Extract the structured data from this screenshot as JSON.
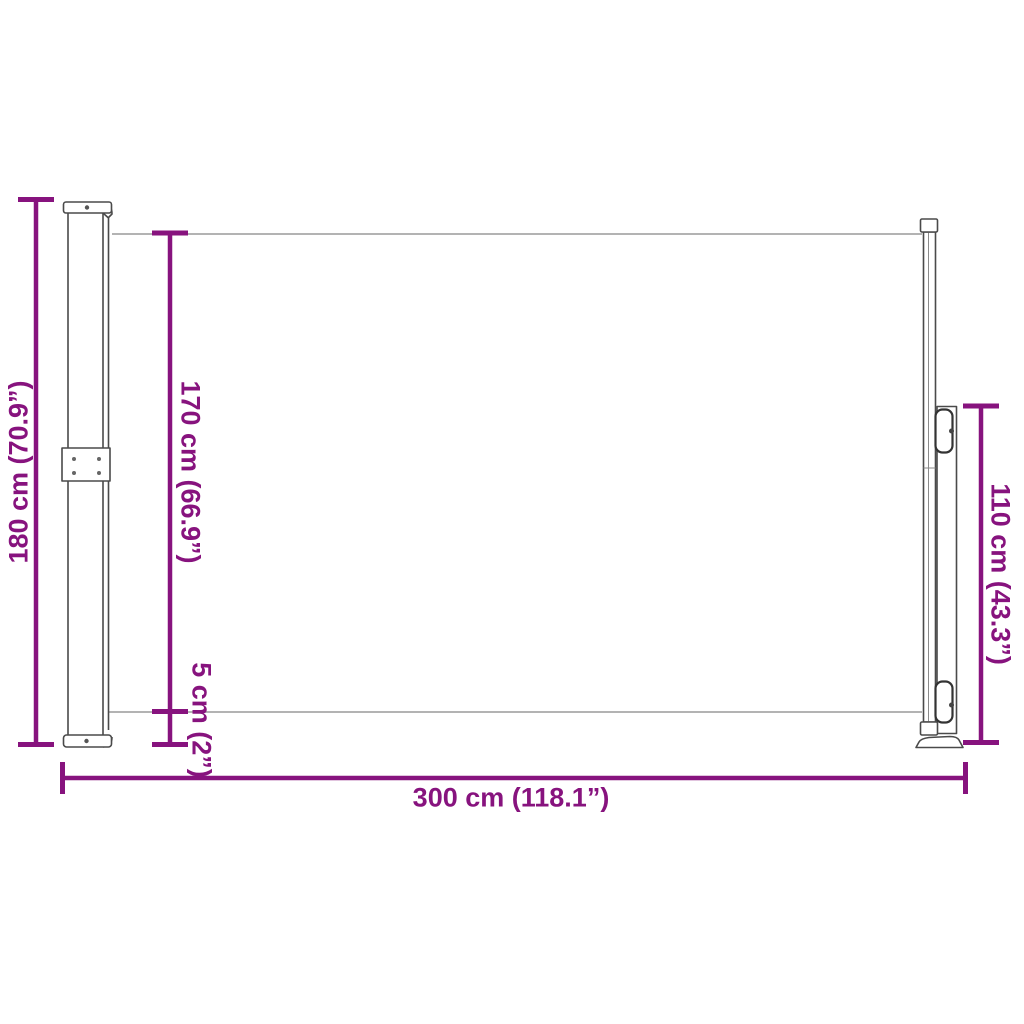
{
  "diagram": {
    "name": "retractable-side-awning-dimension-drawing",
    "background_color": "#ffffff",
    "accent_color": "#87137E",
    "outline_color": "#4a4a4a",
    "fabric_line_color": "#9a9a9a",
    "labels": {
      "total_height": "180 cm (70.9”)",
      "fabric_height": "170 cm (66.9”)",
      "bottom_gap": "5 cm (2”)",
      "post_height": "110 cm (43.3”)",
      "total_width": "300 cm (118.1”)"
    }
  }
}
